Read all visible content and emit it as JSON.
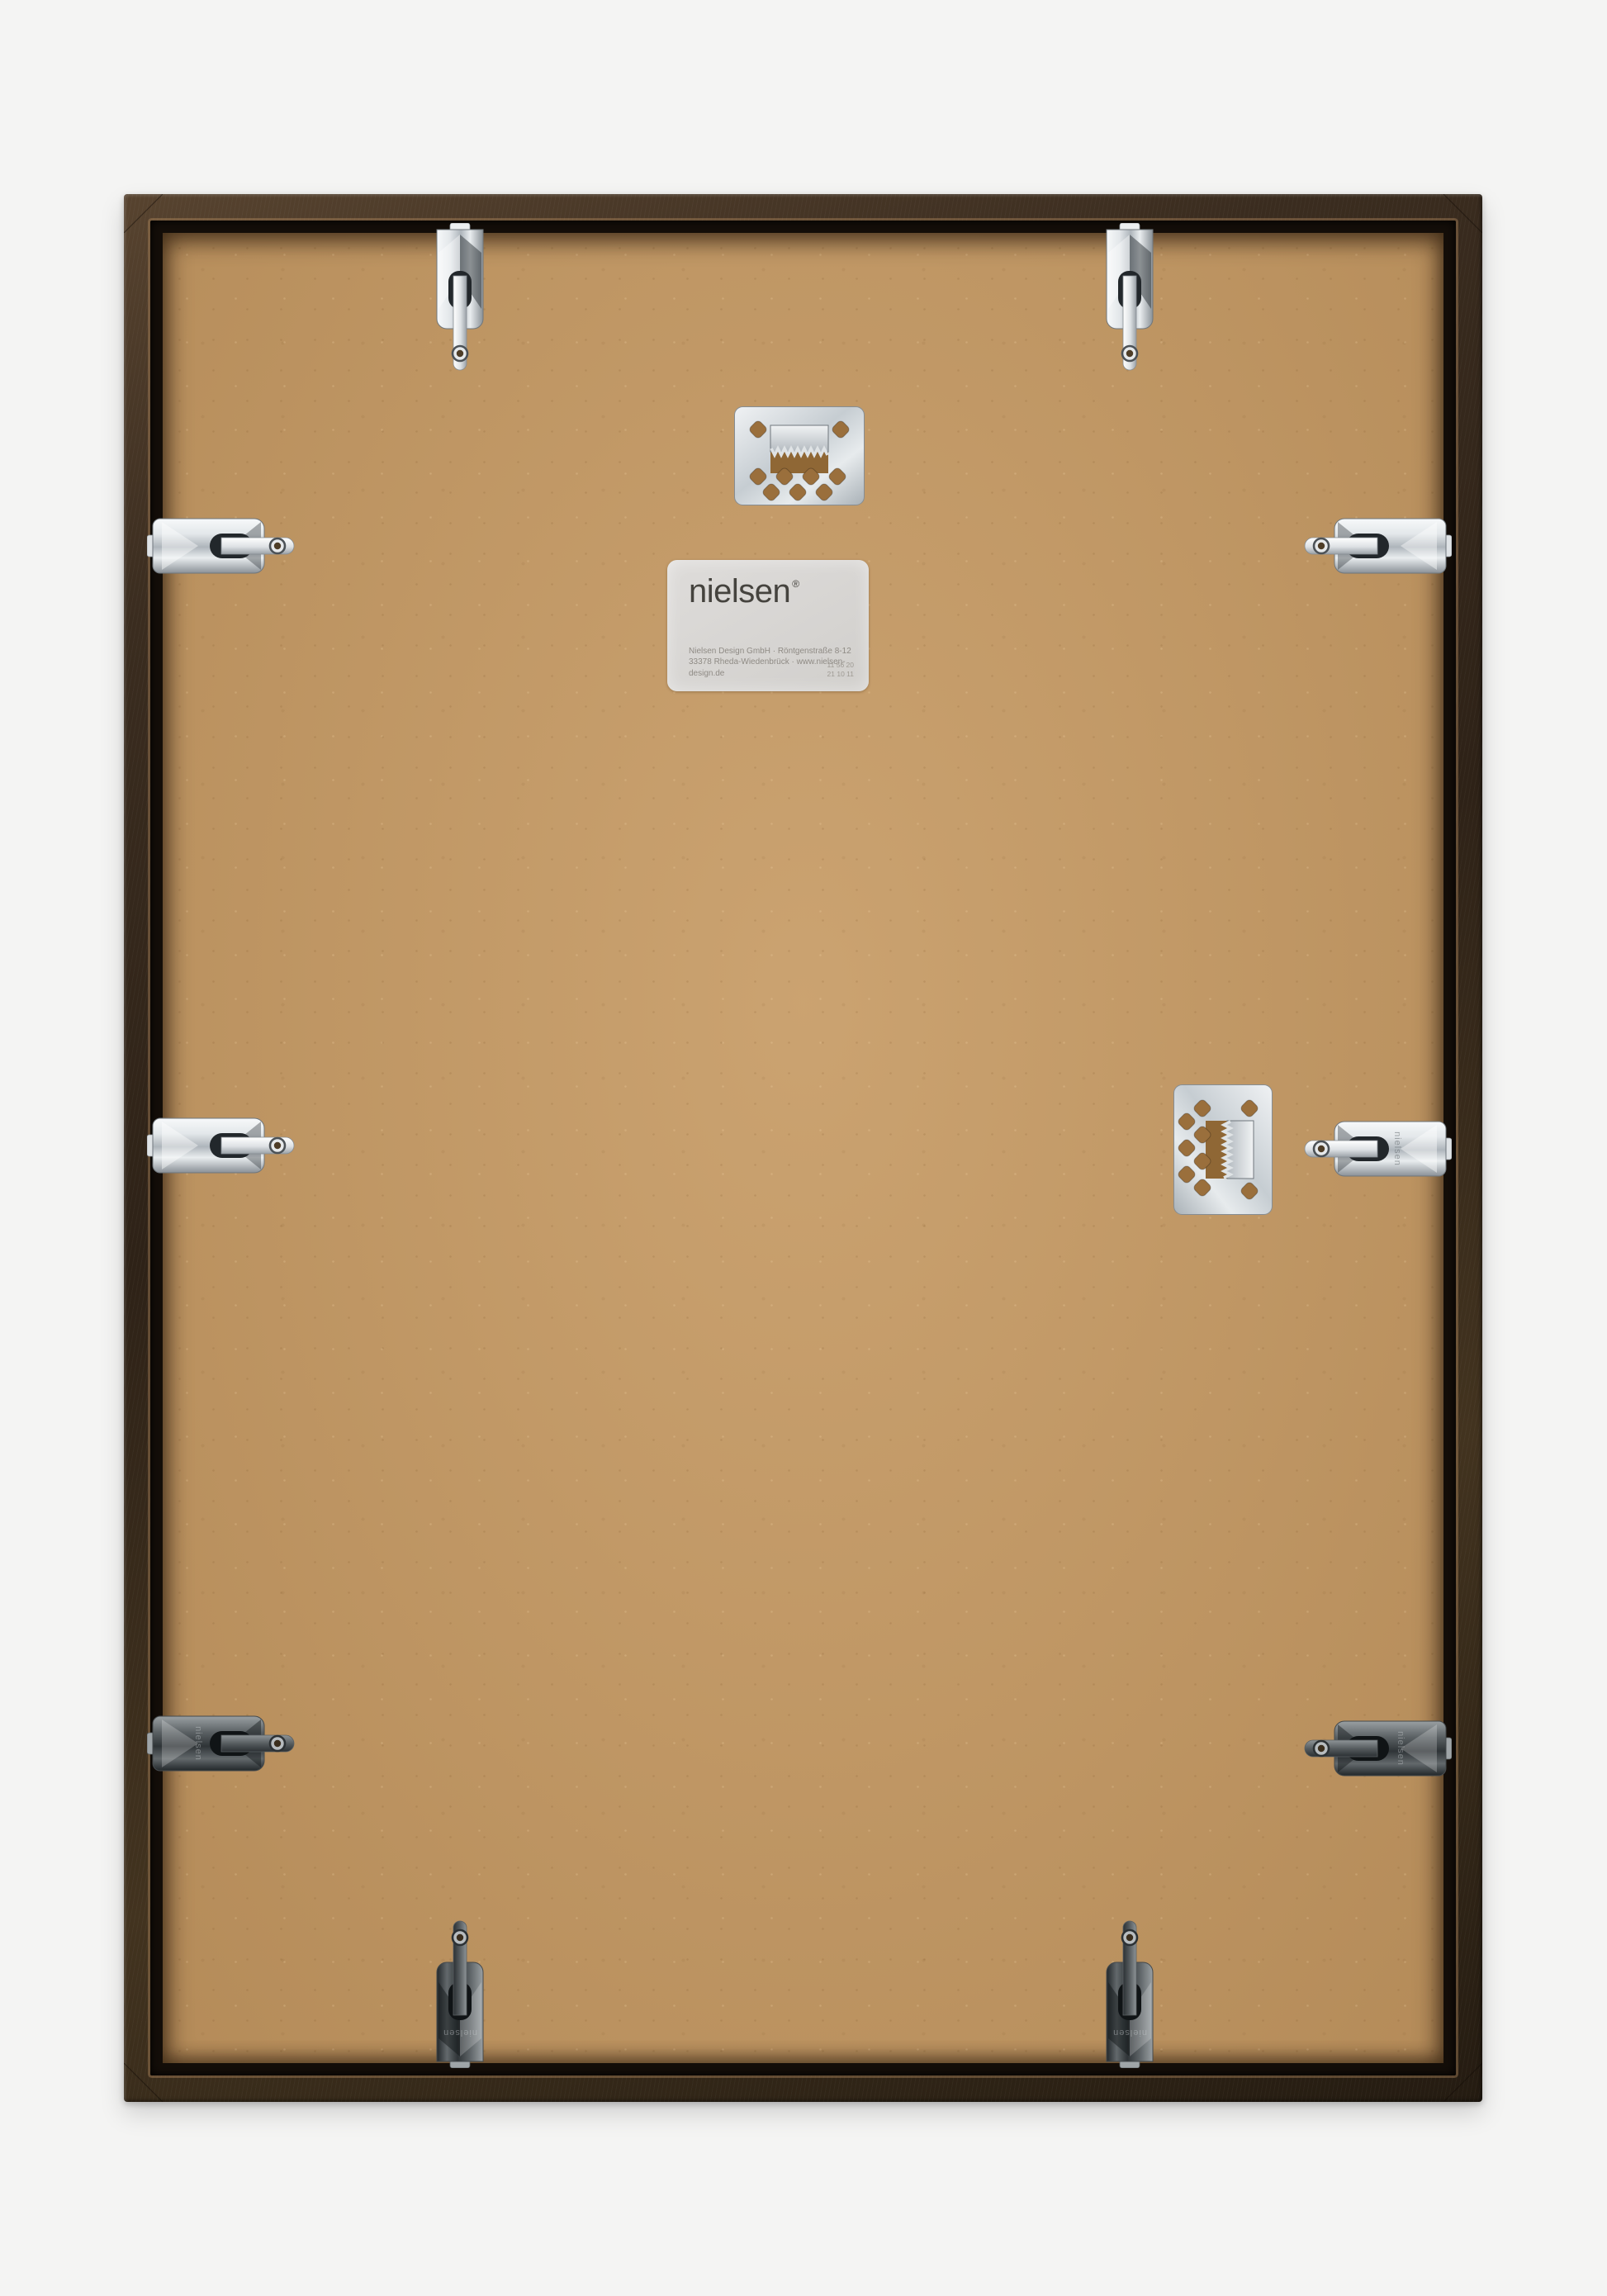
{
  "photo": {
    "subject": "Back of a nielsen wooden picture frame with MDF backing board",
    "background_color": "#f4f4f3",
    "frame_wood_color": "#3a2c1f",
    "board_color": "#c59a65",
    "metal_chrome_color": "#d6dadd",
    "metal_dark_color": "#33383b"
  },
  "label": {
    "logo_text": "nielsen",
    "registered_mark": "®",
    "address_line_1": "Nielsen Design GmbH · Röntgenstraße 8-12",
    "address_line_2": "33378 Rheda-Wiedenbrück · www.nielsen-design.de",
    "code_line_1": "11 56 20",
    "code_line_2": "21 10 11"
  },
  "hardware": {
    "engraving_text": "nielsen",
    "spring_clip_count": 10,
    "sawtooth_hanger_count": 2
  }
}
